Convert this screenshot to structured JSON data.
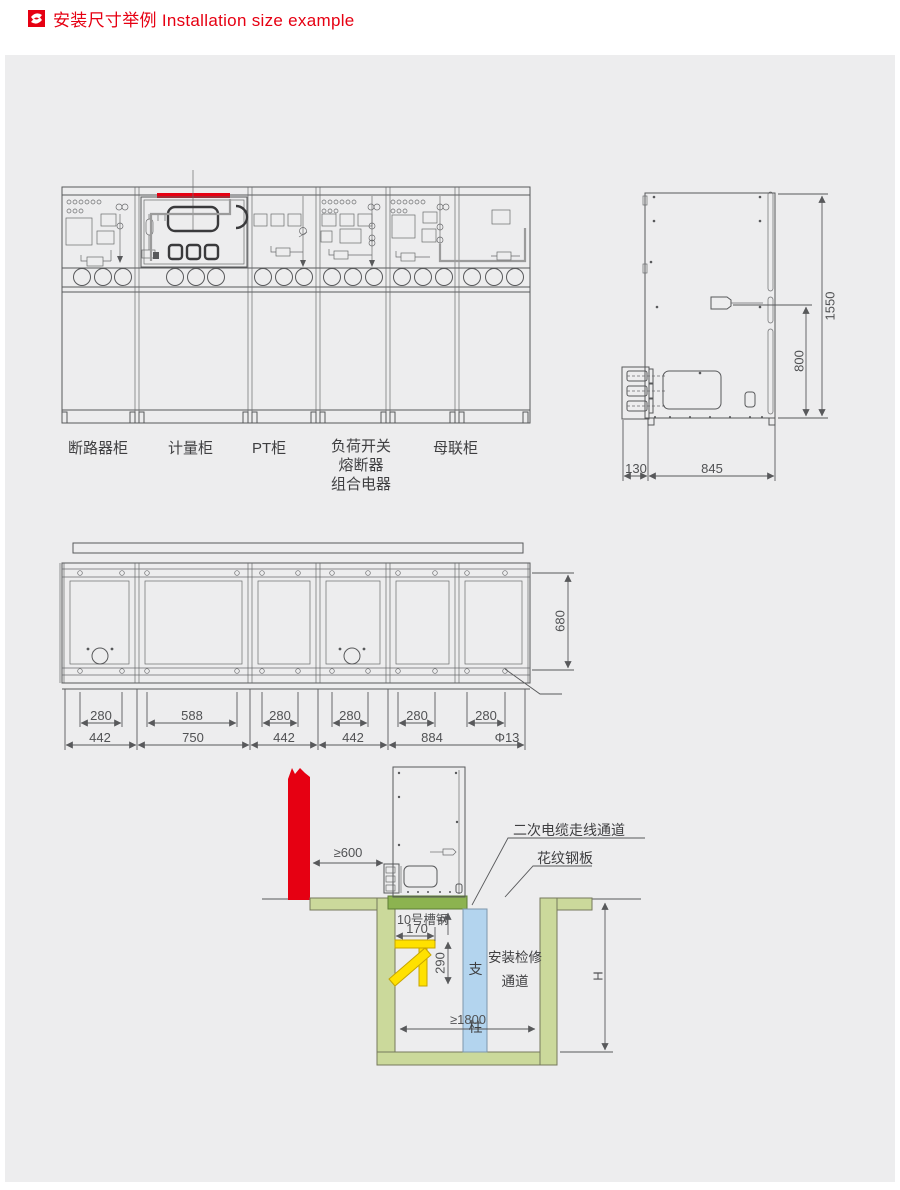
{
  "header": {
    "title": "安装尺寸举例 Installation size example"
  },
  "front_view": {
    "labels": [
      "断路器柜",
      "计量柜",
      "PT柜",
      "负荷开关\n熔断器\n组合电器",
      "母联柜"
    ]
  },
  "side_view": {
    "dim_total_height": "1550",
    "dim_mechanism_height": "800",
    "dim_rear_depth": "130",
    "dim_body_depth": "845"
  },
  "plan_view": {
    "hole_span_dims": [
      "280",
      "588",
      "280",
      "280",
      "280",
      "280"
    ],
    "bay_width_dims": [
      "442",
      "750",
      "442",
      "442",
      "884"
    ],
    "hole_diameter": "Φ13",
    "dim_depth": "680"
  },
  "section_view": {
    "dim_wall_clearance": "≥600",
    "label_cable_channel": "二次电缆走线通道",
    "label_checkered_plate": "花纹钢板",
    "label_channel_steel": "10号槽钢",
    "dim_bracket_width": "170",
    "dim_bracket_drop": "290",
    "dim_beam_height": "h",
    "label_pillar": "支\n柱",
    "label_aisle": "安装检修\n通道",
    "dim_trench_width": "≥1800",
    "dim_trench_depth": "H"
  },
  "colors": {
    "accent_red": "#e60012",
    "beam_green": "#8cb350",
    "trench_green": "#cbd99b",
    "pillar_blue": "#b3d4ee",
    "bracket_yellow": "#ffe100"
  }
}
